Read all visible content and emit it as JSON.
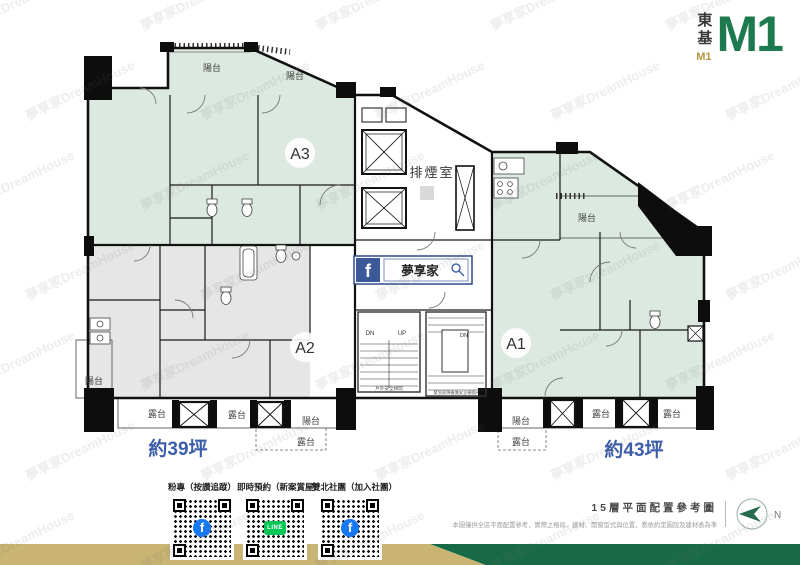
{
  "brand": {
    "company_vertical": "東基",
    "gold_monogram": "M1",
    "logo": "M1"
  },
  "plan": {
    "balcony": "陽台",
    "terrace": "露台",
    "smoke_room": "排煙室",
    "unit_a1": "A1",
    "unit_a2": "A2",
    "unit_a3": "A3",
    "area_a2": "約39坪",
    "area_a1": "約43坪",
    "stair_dn": "DN",
    "stair_up": "UP",
    "stair_left_caption": "戶外安全梯間",
    "stair_right_caption": "緊急昇降機兼安全梯間A",
    "search_banner": "夢享家"
  },
  "footer": {
    "facebook_f": "f",
    "qr_items": [
      {
        "label": "粉專（按讚追蹤）",
        "icon": "facebook"
      },
      {
        "label": "即時預約（新案賞屋）",
        "icon": "line",
        "icon_text": "LINE"
      },
      {
        "label": "雙北社團（加入社團）",
        "icon": "facebook"
      }
    ],
    "plan_title": "15層平面配置參考圖",
    "disclaimer": "本圖僅供全區平面配置參考，實際之格局、建材、開窗型式與位置，悉依約定圖說及建材表為準",
    "compass_n": "N"
  },
  "watermark": {
    "text": "夢享家DreamHouse"
  },
  "colors": {
    "logo_green": "#1d7a4e",
    "bar_gold": "#c9b473",
    "bar_green": "#186a47",
    "unit_fill": "#dce9e1",
    "a2_fill": "#e6e6e6",
    "area_text": "#3c5da9",
    "facebook_blue": "#3b5998",
    "fb_icon_blue": "#1877f2",
    "line_green": "#06c755"
  }
}
